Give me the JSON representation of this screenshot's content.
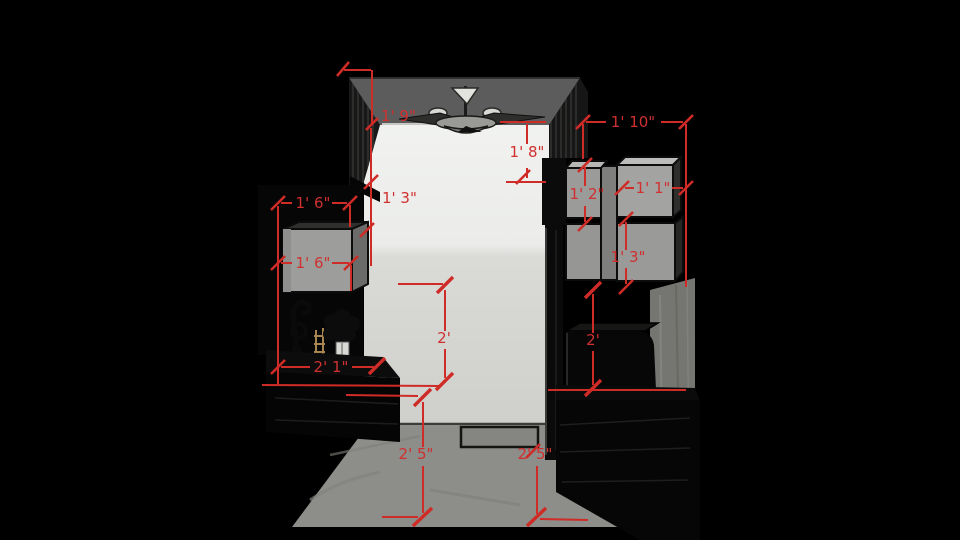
{
  "viewport": {
    "kind": "3d-model-view",
    "accent_color": "#d03030",
    "background_color": "#000000"
  },
  "dimensions": [
    {
      "id": "ceiling-soffit-left",
      "label": "1' 9\""
    },
    {
      "id": "left-wall-gap",
      "label": "1' 3\""
    },
    {
      "id": "right-soffit-drop",
      "label": "1' 8\""
    },
    {
      "id": "right-top-width",
      "label": "1' 10\""
    },
    {
      "id": "right-upper-cab-height",
      "label": "1' 2\""
    },
    {
      "id": "right-upper-cab-width",
      "label": "1' 1\""
    },
    {
      "id": "right-lower-cab-height",
      "label": "1' 3\""
    },
    {
      "id": "left-upper-cab-width-top",
      "label": "1' 6\""
    },
    {
      "id": "left-upper-cab-width",
      "label": "1' 6\""
    },
    {
      "id": "center-wall-clearance",
      "label": "2'"
    },
    {
      "id": "right-counter-clearance",
      "label": "2'"
    },
    {
      "id": "left-counter-depth",
      "label": "2' 1\""
    },
    {
      "id": "left-counter-height",
      "label": "2' 5\""
    },
    {
      "id": "right-counter-height",
      "label": "2' 5\""
    }
  ]
}
